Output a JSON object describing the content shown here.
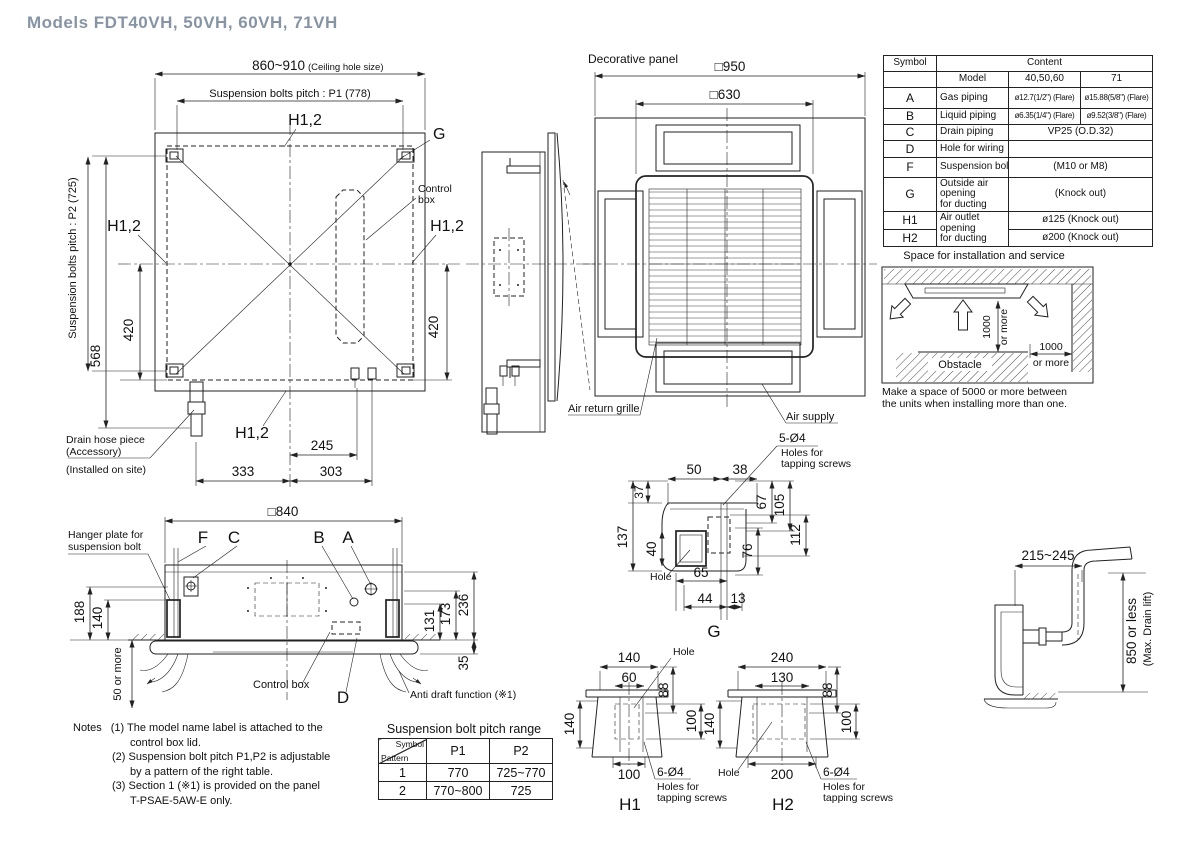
{
  "colors": {
    "title": "#8794a4",
    "line": "#222222"
  },
  "title": "Models  FDT40VH, 50VH, 60VH, 71VH",
  "plan": {
    "ceiling_hole": "860~910",
    "ceiling_hole_note": "(Ceiling hole size)",
    "p1": "Suspension bolts pitch : P1 (778)",
    "p2": "Suspension bolts pitch : P2 (725)",
    "h12": "H1,2",
    "g": "G",
    "control1": "Control",
    "control2": "box",
    "d420": "420",
    "d568": "568",
    "d245": "245",
    "d333": "333",
    "d303": "303",
    "drain1": "Drain hose piece",
    "drain2": "(Accessory)",
    "drain3": "(Installed on site)"
  },
  "panel": {
    "title": "Decorative panel",
    "d950": "□950",
    "d630": "□630",
    "air_return": "Air return grille",
    "air_supply": "Air supply"
  },
  "symbol_table": {
    "h_symbol": "Symbol",
    "h_content": "Content",
    "h_model": "Model",
    "h_m1": "40,50,60",
    "h_m2": "71",
    "a_sym": "A",
    "a_name": "Gas piping",
    "a_v1": "ø12.7(1/2\") (Flare)",
    "a_v2": "ø15.88(5/8\") (Flare)",
    "b_sym": "B",
    "b_name": "Liquid piping",
    "b_v1": "ø6.35(1/4\") (Flare)",
    "b_v2": "ø9.52(3/8\") (Flare)",
    "c_sym": "C",
    "c_name": "Drain piping",
    "c_v": "VP25 (O.D.32)",
    "d_sym": "D",
    "d_name": "Hole for wiring",
    "d_v": "",
    "f_sym": "F",
    "f_name": "Suspension bolts",
    "f_v": "(M10 or M8)",
    "g_sym": "G",
    "g_name1": "Outside air opening",
    "g_name2": "for ducting",
    "g_v": "(Knock out)",
    "h1_sym": "H1",
    "h2_sym": "H2",
    "h_name1": "Air outlet opening",
    "h_name2": "for ducting",
    "h1_v": "ø125 (Knock out)",
    "h2_v": "ø200 (Knock out)"
  },
  "space": {
    "title": "Space for installation and service",
    "v1000": "1000",
    "v1000b": "or more",
    "h1000": "1000",
    "h1000b": "or more",
    "obstacle": "Obstacle",
    "note1": "Make a space of 5000 or more between",
    "note2": "the units when installing more than one."
  },
  "elev": {
    "d840": "□840",
    "f": "F",
    "c": "C",
    "b": "B",
    "a": "A",
    "hanger1": "Hanger plate for",
    "hanger2": "suspension bolt",
    "d188": "188",
    "d140": "140",
    "d50": "50 or more",
    "control_box": "Control box",
    "d": "D",
    "anti": "Anti draft function (※1)",
    "d131": "131",
    "d173": "173",
    "d236": "236",
    "d35": "35"
  },
  "notes": {
    "label": "Notes",
    "l1a": "(1) The model name label is attached to the",
    "l1b": "control box lid.",
    "l2a": "(2) Suspension bolt pitch P1,P2 is adjustable",
    "l2b": "by a pattern of the right table.",
    "l3a": "(3) Section 1 (※1) is provided on the panel",
    "l3b": "T-PSAE-5AW-E only."
  },
  "pitch_table": {
    "title": "Suspension bolt pitch range",
    "h_symbol": "Symbol",
    "h_pattern": "Pattern",
    "h_p1": "P1",
    "h_p2": "P2",
    "r1_pattern": "1",
    "r1_p1": "770",
    "r1_p2": "725~770",
    "r2_pattern": "2",
    "r2_p1": "770~800",
    "r2_p2": "725"
  },
  "g_detail": {
    "label": "G",
    "screws1": "5-Ø4",
    "screws2": "Holes for",
    "screws3": "tapping screws",
    "hole": "Hole",
    "d50": "50",
    "d38": "38",
    "d37": "37",
    "d137": "137",
    "d40": "40",
    "d67": "67",
    "d105": "105",
    "d112": "112",
    "d76": "76",
    "d65": "65",
    "d44": "44",
    "d13": "13"
  },
  "h1_detail": {
    "label": "H1",
    "hole": "Hole",
    "screws1": "6-Ø4",
    "screws2": "Holes for",
    "screws3": "tapping screws",
    "d140t": "140",
    "d60": "60",
    "d88": "88",
    "d140l": "140",
    "d100r": "100",
    "d100b": "100"
  },
  "h2_detail": {
    "label": "H2",
    "hole": "Hole",
    "screws1": "6-Ø4",
    "screws2": "Holes for",
    "screws3": "tapping screws",
    "d240": "240",
    "d130": "130",
    "d88": "88",
    "d140l": "140",
    "d100r": "100",
    "d200b": "200"
  },
  "drain_lift": {
    "d215": "215~245",
    "d850": "850 or less",
    "d850b": "(Max. Drain lift)"
  }
}
